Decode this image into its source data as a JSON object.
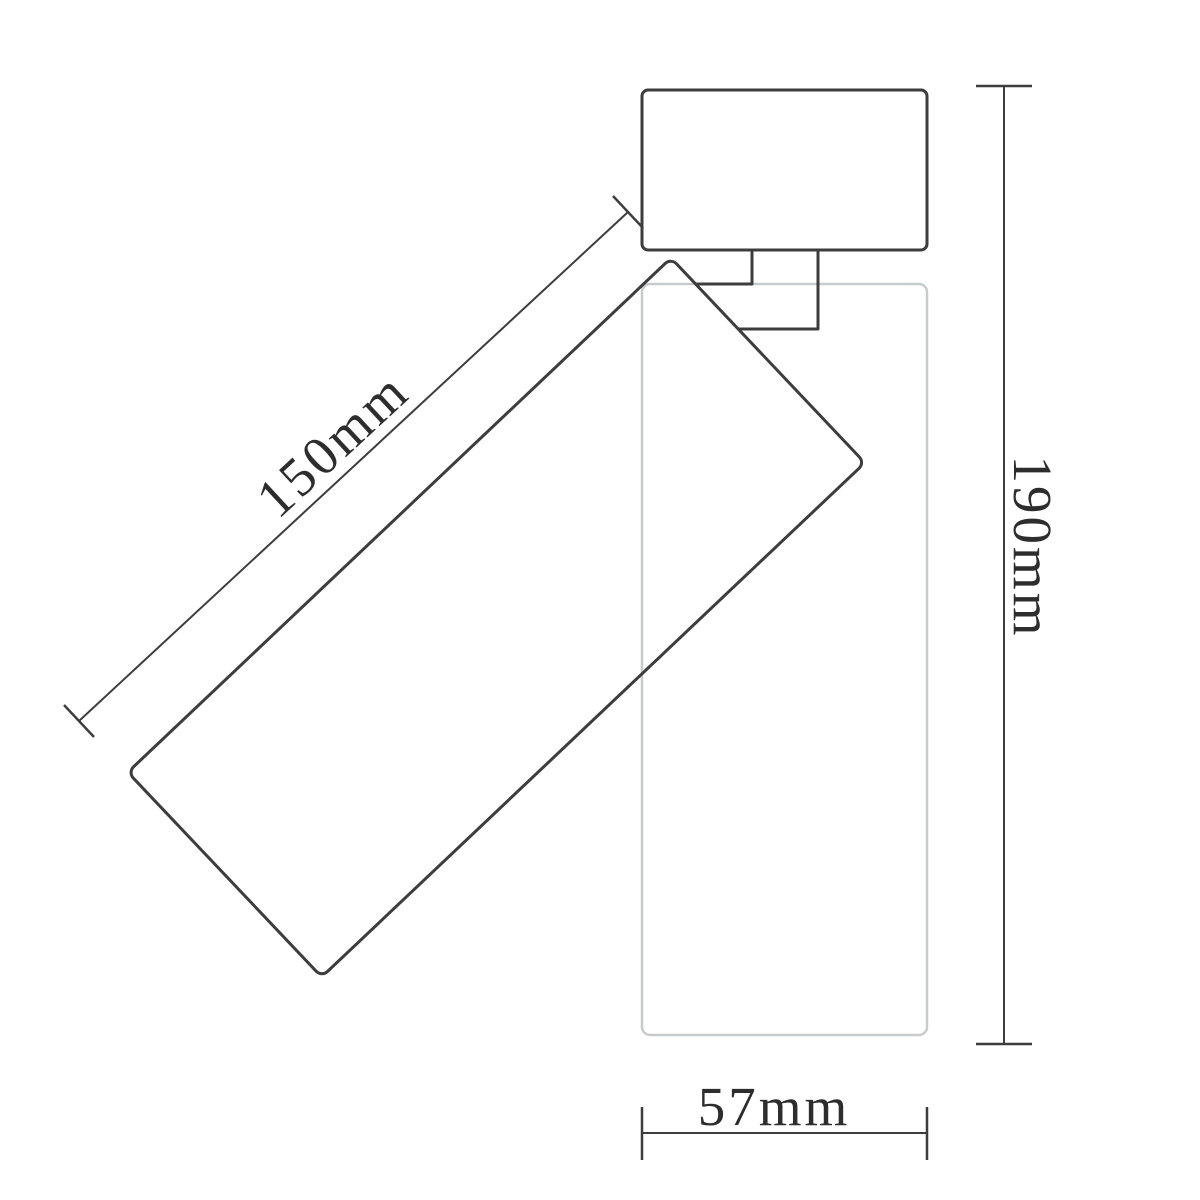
{
  "diagram": {
    "dimensions": {
      "length": {
        "label": "150mm"
      },
      "height": {
        "label": "190mm"
      },
      "width": {
        "label": "57mm"
      }
    },
    "colors": {
      "line": "#3d3d3d",
      "text": "#2d2d2d",
      "ghost_line": "#c8cbce",
      "background": "#ffffff"
    }
  }
}
